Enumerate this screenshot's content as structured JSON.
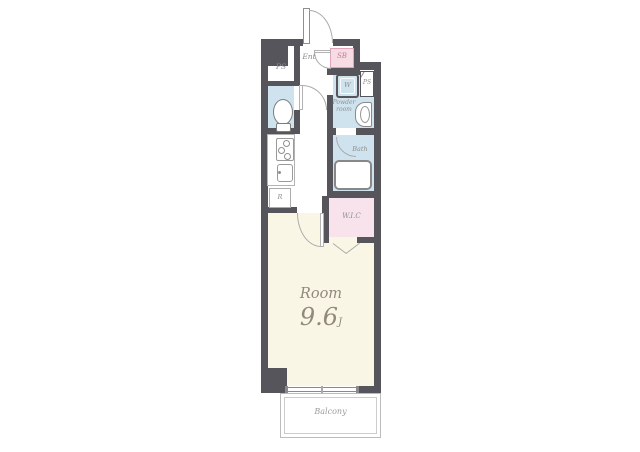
{
  "floorplan": {
    "rooms": {
      "ent": {
        "label": "Ent"
      },
      "shoe_box": {
        "label": "SB"
      },
      "pipe_space_left": {
        "label": "PS"
      },
      "pipe_space_right": {
        "label": "PS"
      },
      "washer": {
        "label": "W"
      },
      "powder_room": {
        "label": "Powder room",
        "line1": "Powder",
        "line2": "room"
      },
      "bath": {
        "label": "Bath"
      },
      "wic": {
        "label": "W.I.C"
      },
      "refrigerator": {
        "label": "R"
      },
      "main_room": {
        "label": "Room",
        "size": "9.6",
        "size_unit": "J"
      },
      "balcony": {
        "label": "Balcony"
      }
    },
    "colors": {
      "wall": "#57555c",
      "room_floor": "#faf6e6",
      "wet_floor": "#cfe3ef",
      "closet_pink": "#f8e3ec",
      "sb_fill": "#f8dce4",
      "sb_border": "#e2a4ba",
      "label": "#8d8d8d",
      "room_label": "#90897c"
    }
  }
}
